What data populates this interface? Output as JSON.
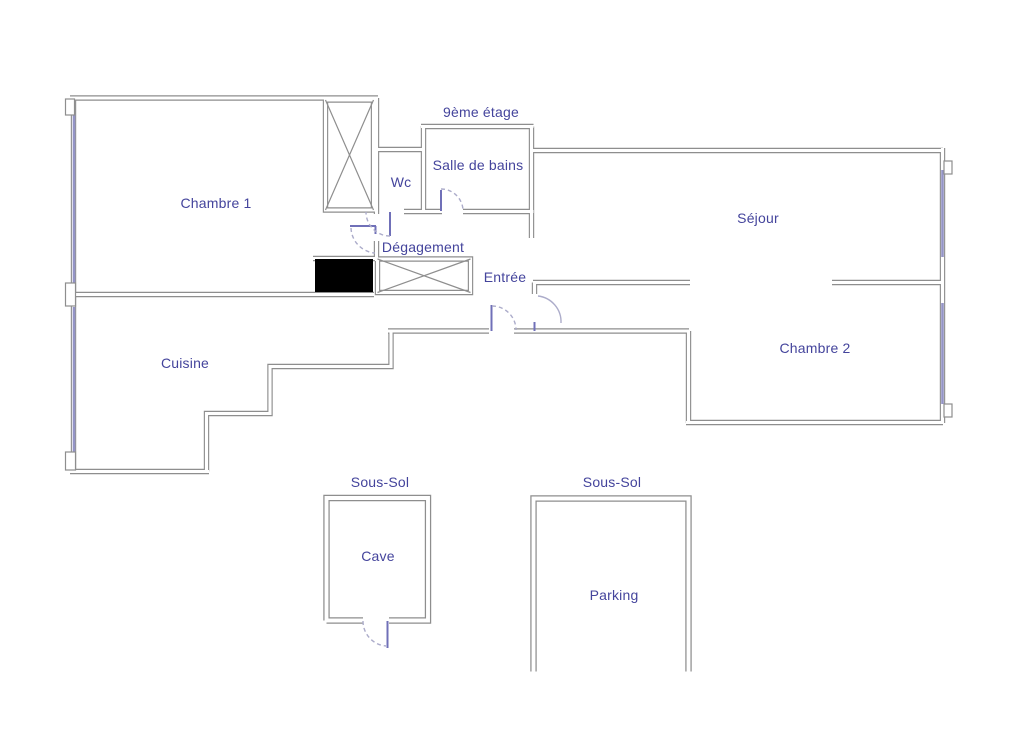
{
  "floorplan": {
    "floor_label": "9ème étage",
    "rooms": {
      "chambre1": "Chambre 1",
      "wc": "Wc",
      "salle_de_bains": "Salle de bains",
      "degagement": "Dégagement",
      "entree": "Entrée",
      "sejour": "Séjour",
      "chambre2": "Chambre 2",
      "cuisine": "Cuisine"
    },
    "basement": {
      "cave_section_label": "Sous-Sol",
      "parking_section_label": "Sous-Sol",
      "cave": "Cave",
      "parking": "Parking"
    },
    "colors": {
      "wall": "#8e8e8e",
      "window": "#9494c6",
      "door_leaf": "#7070b8",
      "door_arc": "#acacca",
      "label": "#44449c",
      "duct": "#000000",
      "background": "#ffffff"
    }
  }
}
